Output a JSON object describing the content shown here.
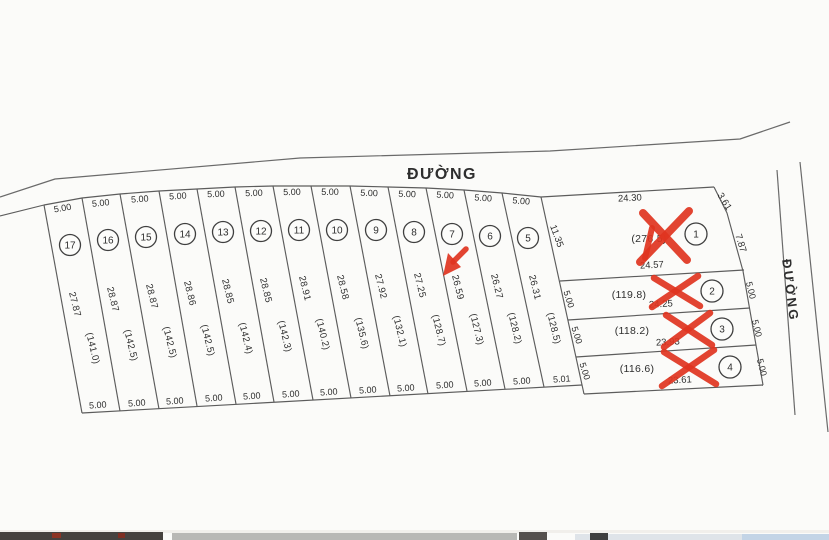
{
  "roads": {
    "top_label": "ĐƯỜNG",
    "right_label": "ĐƯỜNG"
  },
  "strip_plots": [
    {
      "no": "17",
      "top_width": "5.00",
      "length": "27.87",
      "area": "(141.0)",
      "bottom_width": "5.00"
    },
    {
      "no": "16",
      "top_width": "5.00",
      "length": "28.87",
      "area": "(142.5)",
      "bottom_width": "5.00"
    },
    {
      "no": "15",
      "top_width": "5.00",
      "length": "28.87",
      "area": "(142.5)",
      "bottom_width": "5.00"
    },
    {
      "no": "14",
      "top_width": "5.00",
      "length": "28.86",
      "area": "(142.5)",
      "bottom_width": "5.00"
    },
    {
      "no": "13",
      "top_width": "5.00",
      "length": "28.85",
      "area": "(142.4)",
      "bottom_width": "5.00"
    },
    {
      "no": "12",
      "top_width": "5.00",
      "length": "28.85",
      "area": "(142.3)",
      "bottom_width": "5.00"
    },
    {
      "no": "11",
      "top_width": "5.00",
      "length": "28.91",
      "area": "(140.2)",
      "bottom_width": "5.00"
    },
    {
      "no": "10",
      "top_width": "5.00",
      "length": "28.58",
      "area": "(135.6)",
      "bottom_width": "5.00"
    },
    {
      "no": "9",
      "top_width": "5.00",
      "length": "27.92",
      "area": "(132.1)",
      "bottom_width": "5.00"
    },
    {
      "no": "8",
      "top_width": "5.00",
      "length": "27.25",
      "area": "(128.7)",
      "bottom_width": "5.00"
    },
    {
      "no": "7",
      "top_width": "5.00",
      "length": "26.59",
      "area": "(127.3)",
      "bottom_width": "5.00"
    },
    {
      "no": "6",
      "top_width": "5.00",
      "length": "26.27",
      "area": "(128.2)",
      "bottom_width": "5.00"
    },
    {
      "no": "5",
      "top_width": "5.00",
      "length": "26.31",
      "area": "(128.5)",
      "bottom_width": "5.01"
    }
  ],
  "block_plots": {
    "plot1": {
      "no": "1",
      "top_edge": "24.30",
      "corner_edge": "3.61",
      "right_edge": "7.87",
      "left_edge": "11.35",
      "area": "(276.5)",
      "bottom_edge": "24.57"
    },
    "plot2": {
      "no": "2",
      "left_edge": "5.00",
      "area": "(119.8)",
      "bottom_edge": "24.25",
      "right_edge": "5.00"
    },
    "plot3": {
      "no": "3",
      "left_edge": "5.00",
      "area": "(118.2)",
      "bottom_edge": "23.93",
      "right_edge": "5.00"
    },
    "plot4": {
      "no": "4",
      "left_edge": "5.00",
      "area": "(116.6)",
      "bottom_edge": "23.61",
      "right_edge": "5.00"
    }
  },
  "annotations": {
    "red_cross_plots": [
      "1",
      "2",
      "3",
      "4"
    ],
    "red_arrow_plot": "7",
    "mark_color": "#df3420"
  },
  "colors": {
    "line": "#5c5c5c",
    "text": "#2e2e2e",
    "background": "#fbfbf9"
  }
}
